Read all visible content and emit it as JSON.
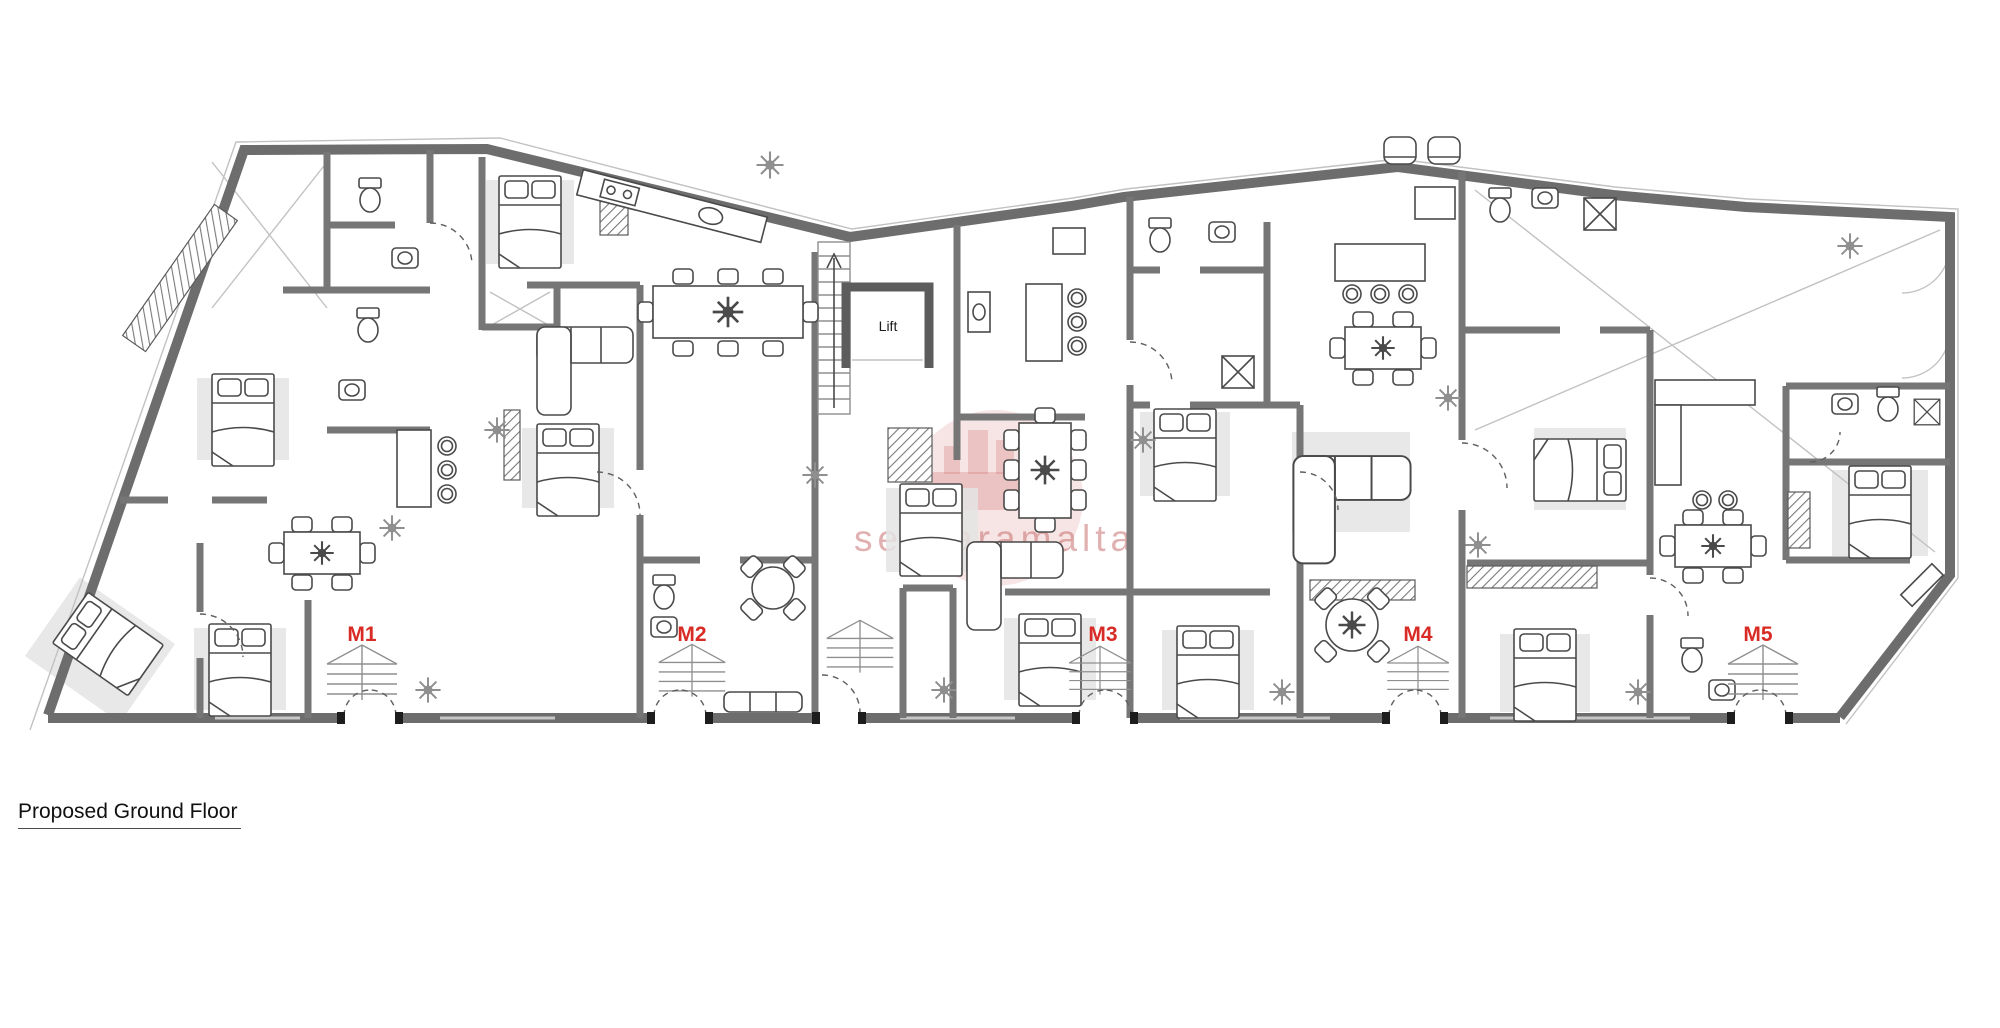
{
  "title": {
    "text": "Proposed Ground Floor"
  },
  "plan": {
    "lift_label": "Lift",
    "units": [
      {
        "id": "M1",
        "label": "M1"
      },
      {
        "id": "M2",
        "label": "M2"
      },
      {
        "id": "M3",
        "label": "M3"
      },
      {
        "id": "M4",
        "label": "M4"
      },
      {
        "id": "M5",
        "label": "M5"
      }
    ],
    "watermark_text": "sensaramalta"
  },
  "colors": {
    "wall_gray": "#6d6d6d",
    "wall_dark": "#5c5c5c",
    "furniture_line": "#4a4a4a",
    "unit_label_red": "#d92b26",
    "watermark_pink": "#cc8383",
    "rug_gray": "#e4e4e4",
    "title_black": "#111111"
  }
}
